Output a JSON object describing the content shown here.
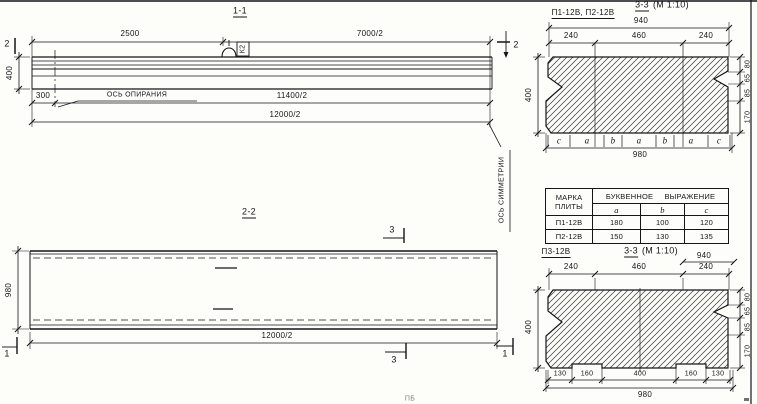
{
  "s11": {
    "title": "1-1",
    "dim_2500": "2500",
    "dim_7000": "7000/2",
    "dim_300": "300",
    "dim_11400": "11400/2",
    "dim_12000": "12000/2",
    "dim_400": "400",
    "bearing_axis": "ОСЬ ОПИРАНИЯ",
    "loop_mark": "К2",
    "cut_left": "2",
    "cut_right": "2"
  },
  "s22": {
    "title": "2-2",
    "dim_980": "980",
    "dim_12000": "12000/2",
    "symmetry_axis": "ОСЬ СИММЕТРИИ",
    "cut3_top": "3",
    "cut3_bottom": "3",
    "cut1_left": "1",
    "cut1_right": "1"
  },
  "s33top": {
    "label": "П1-12В, П2-12В",
    "title": "3-3",
    "scale": "(М 1:10)",
    "dim_940": "940",
    "dims_top": [
      "240",
      "460",
      "240"
    ],
    "dim_400": "400",
    "dims_right": [
      "80",
      "65",
      "85",
      "170"
    ],
    "letters": [
      "c",
      "a",
      "b",
      "a",
      "b",
      "a",
      "c"
    ],
    "dim_980": "980"
  },
  "table": {
    "header_col1_line1": "МАРКА",
    "header_col1_line2": "ПЛИТЫ",
    "header_expr": "БУКВЕННОЕ ВЫРАЖЕНИЕ",
    "sub": [
      "a",
      "b",
      "c"
    ],
    "rows": [
      {
        "mark": "П1-12В",
        "a": "180",
        "b": "100",
        "c": "120"
      },
      {
        "mark": "П2-12В",
        "a": "150",
        "b": "130",
        "c": "135"
      }
    ]
  },
  "s33bot": {
    "label": "П3-12В",
    "title": "3-3",
    "scale": "(М 1:10)",
    "dim_940": "940",
    "dims_top": [
      "240",
      "460",
      "240"
    ],
    "dim_400": "400",
    "dims_right": [
      "80",
      "65",
      "85",
      "170"
    ],
    "dims_bottom": [
      "130",
      "160",
      "400",
      "160",
      "130"
    ],
    "dim_980": "980"
  },
  "footer": {
    "mark": "ПБ"
  }
}
